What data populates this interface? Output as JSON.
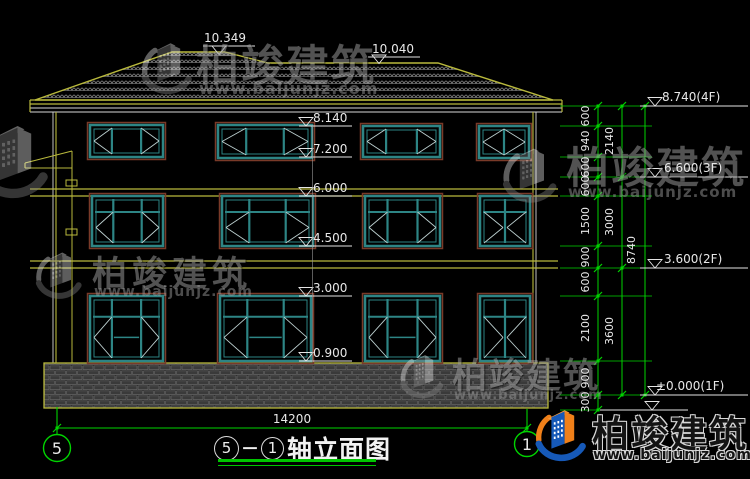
{
  "drawing": {
    "title": {
      "axis_left": "5",
      "separator": "－",
      "axis_right": "1",
      "name": "轴立面图"
    },
    "axis_bubbles": {
      "left": "5",
      "right": "1"
    },
    "overall_width_mm": "14200"
  },
  "elevation_markers": {
    "roof": [
      "10.349",
      "10.040"
    ],
    "middle": [
      "8.140",
      "7.200",
      "6.000",
      "4.500",
      "3.000",
      "0.900"
    ],
    "right": [
      "8.740(4F)",
      "6.600(3F)",
      "3.600(2F)",
      "±0.000(1F)"
    ]
  },
  "dimension_chains": {
    "inner": [
      "600",
      "940",
      "600",
      "600",
      "1500",
      "900",
      "600",
      "2100",
      "900",
      "300"
    ],
    "middle": [
      "2140",
      "3000",
      "3600"
    ],
    "outer": [
      "8740"
    ]
  },
  "watermark": {
    "brand": "柏竣建筑",
    "url": "www.baijunjz.com"
  },
  "colors": {
    "cad_yellow": "#b9b93c",
    "cad_green": "#00d400",
    "cad_white": "#e5e5e5",
    "window_teal": "#2d8585",
    "window_trim": "#7a3a28",
    "logo_blue": "#1659b8",
    "logo_orange": "#f08019"
  }
}
